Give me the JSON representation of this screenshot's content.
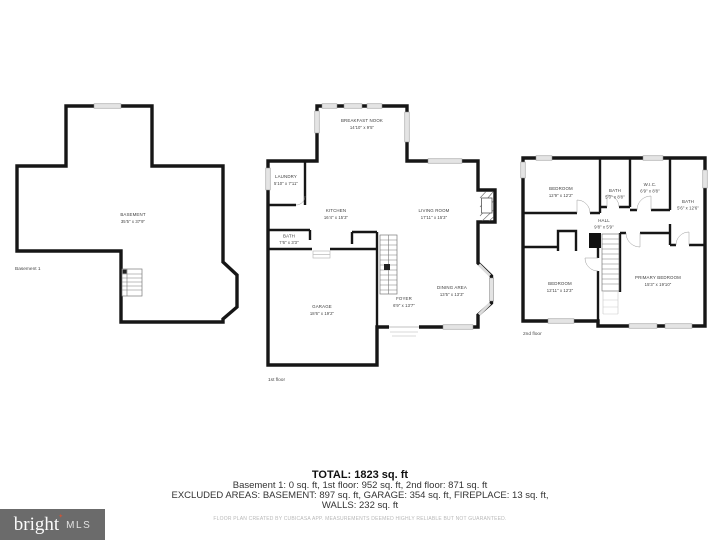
{
  "plans": {
    "basement": {
      "floor_label": "Basement 1",
      "rooms": [
        {
          "name": "BASEMENT",
          "dims": "35'5\" x 37'9\""
        }
      ]
    },
    "first": {
      "floor_label": "1st floor",
      "rooms": [
        {
          "name": "BREAKFAST NOOK",
          "dims": "14'10\" x 9'5\""
        },
        {
          "name": "LAUNDRY",
          "dims": "5'10\" x 7'11\""
        },
        {
          "name": "KITCHEN",
          "dims": "16'4\" x 15'3\""
        },
        {
          "name": "LIVING ROOM",
          "dims": "17'11\" x 15'3\""
        },
        {
          "name": "BATH",
          "dims": "7'6\" x 3'3\""
        },
        {
          "name": "GARAGE",
          "dims": "18'6\" x 19'2\""
        },
        {
          "name": "FOYER",
          "dims": "6'9\" x 13'7\""
        },
        {
          "name": "DINING AREA",
          "dims": "13'5\" x 13'3\""
        }
      ]
    },
    "second": {
      "floor_label": "2nd floor",
      "rooms": [
        {
          "name": "BEDROOM",
          "dims": "12'9\" x 12'2\""
        },
        {
          "name": "BATH",
          "dims": "5'0\" x 8'8\""
        },
        {
          "name": "W.I.C.",
          "dims": "6'9\" x 8'8\""
        },
        {
          "name": "BATH",
          "dims": "5'6\" x 12'6\""
        },
        {
          "name": "HALL",
          "dims": "9'8\" x 5'9\""
        },
        {
          "name": "BEDROOM",
          "dims": "12'11\" x 12'3\""
        },
        {
          "name": "PRIMARY BEDROOM",
          "dims": "15'3\" x 19'10\""
        }
      ]
    }
  },
  "summary": {
    "total": "TOTAL: 1823 sq. ft",
    "floors": "Basement 1: 0 sq. ft, 1st floor: 952 sq. ft, 2nd floor: 871 sq. ft",
    "excluded": "EXCLUDED AREAS: BASEMENT: 897 sq. ft, GARAGE: 354 sq. ft, FIREPLACE: 13 sq. ft,",
    "walls": "WALLS: 232 sq. ft",
    "disclaimer": "FLOOR PLAN CREATED BY CUBICASA APP. MEASUREMENTS DEEMED HIGHLY RELIABLE BUT NOT GUARANTEED."
  },
  "logo": {
    "brand": "bright",
    "suffix": "MLS",
    "bg_color": "#6b6b6b",
    "accent_color": "#c4573c"
  },
  "colors": {
    "walls": "#161616",
    "windows": "#e4e4e4",
    "background": "#ffffff"
  }
}
